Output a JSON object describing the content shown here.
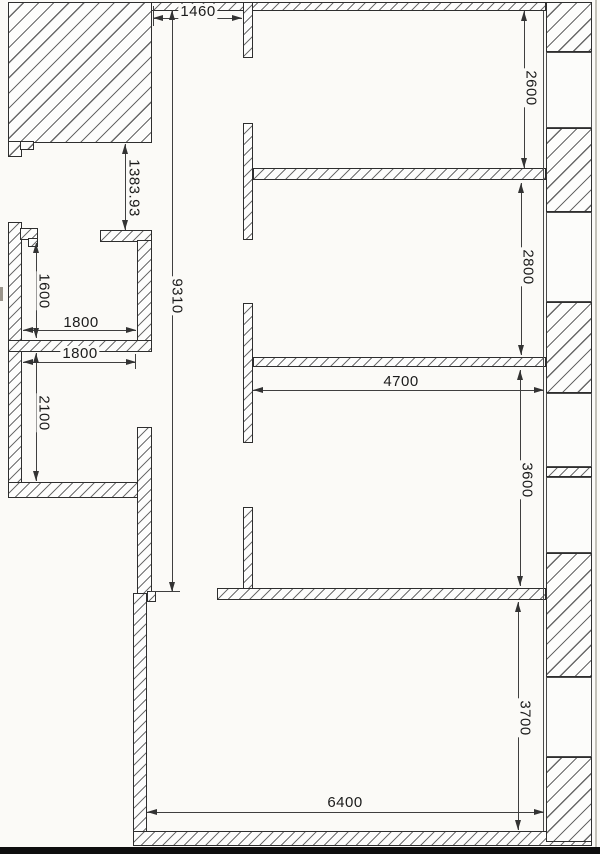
{
  "drawing": {
    "type": "architectural-floor-plan",
    "units": "mm",
    "line_color": "#2e2e2e",
    "paper_color": "#fbfaf7",
    "dims": {
      "d1460": "1460",
      "d1383": "1383.93",
      "d9310": "9310",
      "d1600": "1600",
      "d1800a": "1800",
      "d1800b": "1800",
      "d2100": "2100",
      "d2600": "2600",
      "d2800": "2800",
      "d4700": "4700",
      "d3600": "3600",
      "d3700": "3700",
      "d6400": "6400"
    }
  }
}
